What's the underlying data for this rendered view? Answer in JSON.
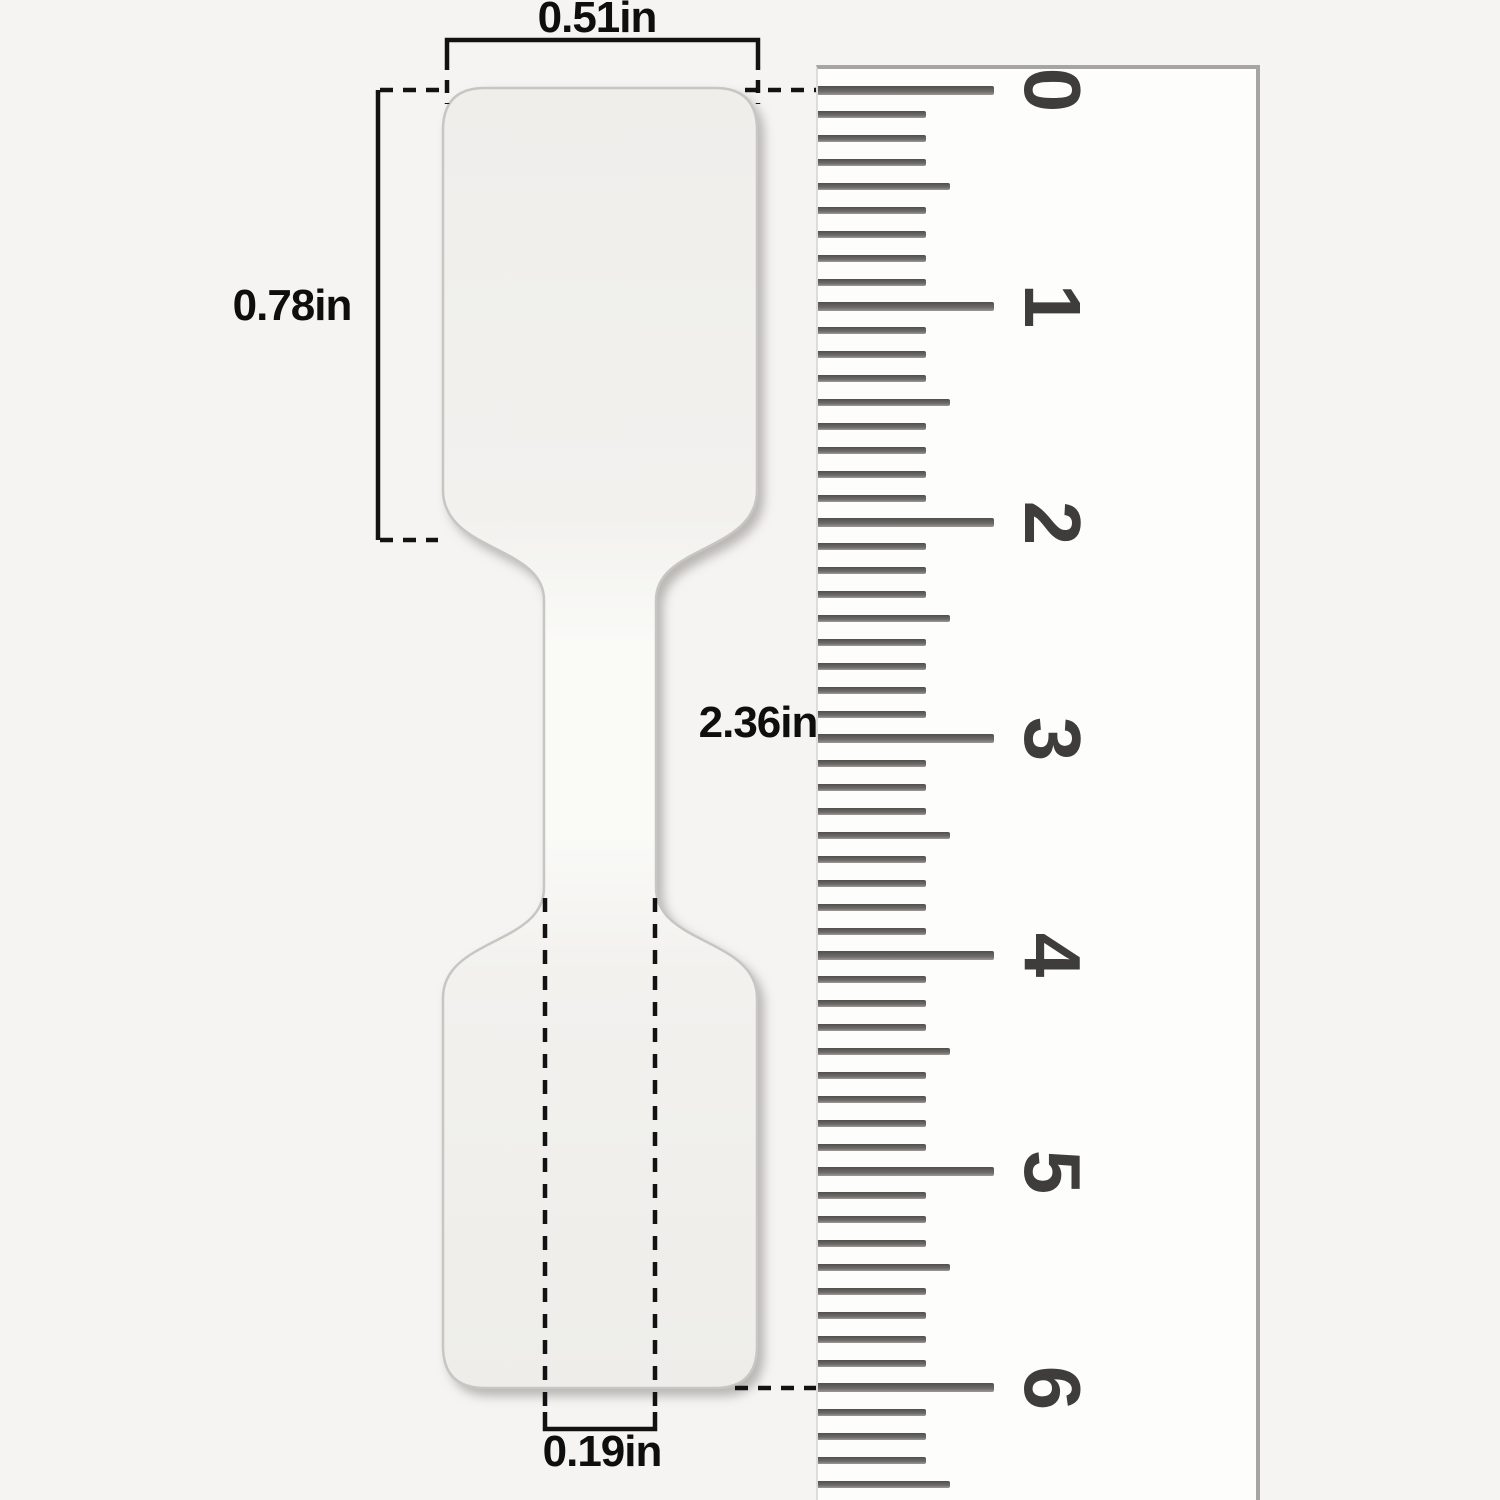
{
  "figure": {
    "description": "Size diagram of a blank dumbbell-shaped jewelry price label sticker shown against a vertical ruler"
  },
  "dimension_labels": {
    "top_width": "0.51in",
    "left_height": "0.78in",
    "total_length": "2.36in",
    "bottom_width": "0.19in"
  },
  "ruler": {
    "numbers": [
      "0",
      "1",
      "2",
      "3",
      "4",
      "5",
      "6"
    ],
    "start_y": 90,
    "unit_px": 216.33,
    "minor_intervals": 9,
    "medium_index": 4,
    "trailing_minor": 4
  },
  "colors": {
    "background": "#f5f4f2",
    "ruler_face": "#fdfdfc",
    "ruler_edge": "#a6a5a3",
    "tick": "#504f4d",
    "ruler_number": "#3e3d3b",
    "sticker_fill": "#f2f1ee",
    "sticker_outline": "#c7c6c3",
    "annotation_line": "#121212",
    "label_text": "#0e0e0e"
  }
}
